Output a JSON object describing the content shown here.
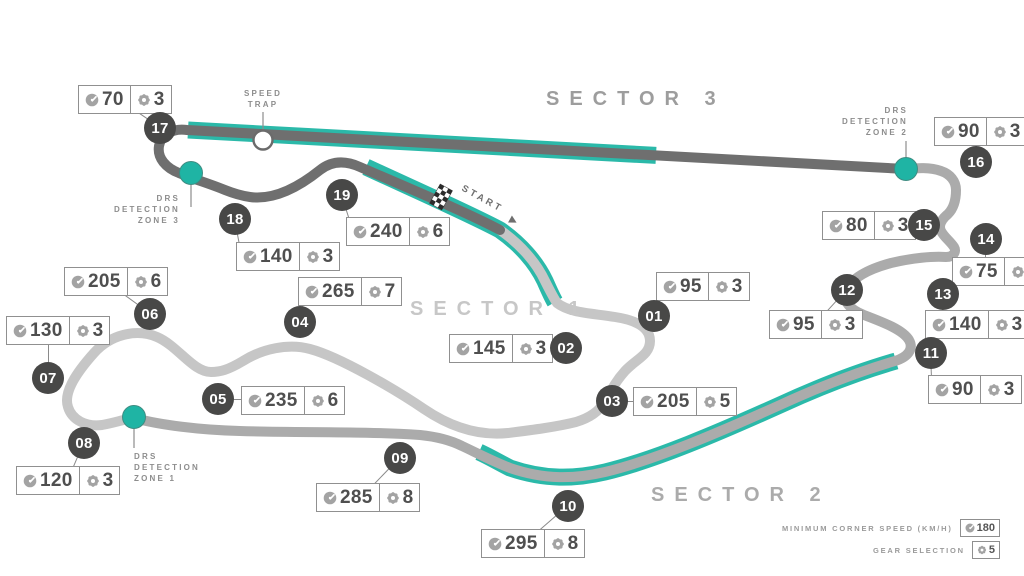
{
  "title": "F1 circuit map",
  "colors": {
    "teal": "#2bb9a9",
    "track_light": "#c6c6c6",
    "track_medium": "#ababab",
    "track_dark": "#6f6f6f",
    "badge_bg": "#484847",
    "label_gray": "#8d8d8d"
  },
  "sectors": [
    {
      "label": "SECTOR 1",
      "color": "#c7c7c7"
    },
    {
      "label": "SECTOR 2",
      "color": "#ababab"
    },
    {
      "label": "SECTOR 3",
      "color": "#9d9d9d"
    }
  ],
  "start": {
    "label": "START"
  },
  "speed_trap": {
    "line1": "SPEED",
    "line2": "TRAP"
  },
  "drs_zones": [
    {
      "line1": "DRS",
      "line2": "DETECTION",
      "line3": "ZONE 1"
    },
    {
      "line1": "DRS",
      "line2": "DETECTION",
      "line3": "ZONE 2"
    },
    {
      "line1": "DRS",
      "line2": "DETECTION",
      "line3": "ZONE 3"
    }
  ],
  "turns": [
    {
      "number": "01",
      "speed": "95",
      "gear": "3",
      "badge": {
        "x": 654,
        "y": 316
      },
      "box": {
        "x": 656,
        "y": 272
      }
    },
    {
      "number": "02",
      "speed": "145",
      "gear": "3",
      "badge": {
        "x": 566,
        "y": 348
      },
      "box": {
        "x": 449,
        "y": 334
      }
    },
    {
      "number": "03",
      "speed": "205",
      "gear": "5",
      "badge": {
        "x": 612,
        "y": 401
      },
      "box": {
        "x": 633,
        "y": 387
      }
    },
    {
      "number": "04",
      "speed": "265",
      "gear": "7",
      "badge": {
        "x": 300,
        "y": 322
      },
      "box": {
        "x": 298,
        "y": 277
      }
    },
    {
      "number": "05",
      "speed": "235",
      "gear": "6",
      "badge": {
        "x": 218,
        "y": 399
      },
      "box": {
        "x": 241,
        "y": 386
      }
    },
    {
      "number": "06",
      "speed": "205",
      "gear": "6",
      "badge": {
        "x": 150,
        "y": 314
      },
      "box": {
        "x": 64,
        "y": 267
      }
    },
    {
      "number": "07",
      "speed": "130",
      "gear": "3",
      "badge": {
        "x": 48,
        "y": 378
      },
      "box": {
        "x": 6,
        "y": 316
      }
    },
    {
      "number": "08",
      "speed": "120",
      "gear": "3",
      "badge": {
        "x": 84,
        "y": 443
      },
      "box": {
        "x": 16,
        "y": 466
      }
    },
    {
      "number": "09",
      "speed": "285",
      "gear": "8",
      "badge": {
        "x": 400,
        "y": 458
      },
      "box": {
        "x": 316,
        "y": 483
      }
    },
    {
      "number": "10",
      "speed": "295",
      "gear": "8",
      "badge": {
        "x": 568,
        "y": 506
      },
      "box": {
        "x": 481,
        "y": 529
      }
    },
    {
      "number": "11",
      "speed": "90",
      "gear": "3",
      "badge": {
        "x": 931,
        "y": 353
      },
      "box": {
        "x": 928,
        "y": 375
      }
    },
    {
      "number": "12",
      "speed": "95",
      "gear": "3",
      "badge": {
        "x": 847,
        "y": 290
      },
      "box": {
        "x": 769,
        "y": 310
      }
    },
    {
      "number": "13",
      "speed": "140",
      "gear": "3",
      "badge": {
        "x": 943,
        "y": 294
      },
      "box": {
        "x": 925,
        "y": 310
      }
    },
    {
      "number": "14",
      "speed": "75",
      "gear": "3",
      "badge": {
        "x": 986,
        "y": 239
      },
      "box": {
        "x": 952,
        "y": 257
      }
    },
    {
      "number": "15",
      "speed": "80",
      "gear": "3",
      "badge": {
        "x": 924,
        "y": 225
      },
      "box": {
        "x": 822,
        "y": 211
      }
    },
    {
      "number": "16",
      "speed": "90",
      "gear": "3",
      "badge": {
        "x": 976,
        "y": 162
      },
      "box": {
        "x": 934,
        "y": 117
      }
    },
    {
      "number": "17",
      "speed": "70",
      "gear": "3",
      "badge": {
        "x": 160,
        "y": 128
      },
      "box": {
        "x": 78,
        "y": 85
      }
    },
    {
      "number": "18",
      "speed": "140",
      "gear": "3",
      "badge": {
        "x": 235,
        "y": 219
      },
      "box": {
        "x": 236,
        "y": 242
      }
    },
    {
      "number": "19",
      "speed": "240",
      "gear": "6",
      "badge": {
        "x": 342,
        "y": 195
      },
      "box": {
        "x": 346,
        "y": 217
      }
    }
  ],
  "legend": {
    "speed_label": "MINIMUM CORNER SPEED (KM/H)",
    "speed_value": "180",
    "gear_label": "GEAR SELECTION",
    "gear_value": "5"
  }
}
